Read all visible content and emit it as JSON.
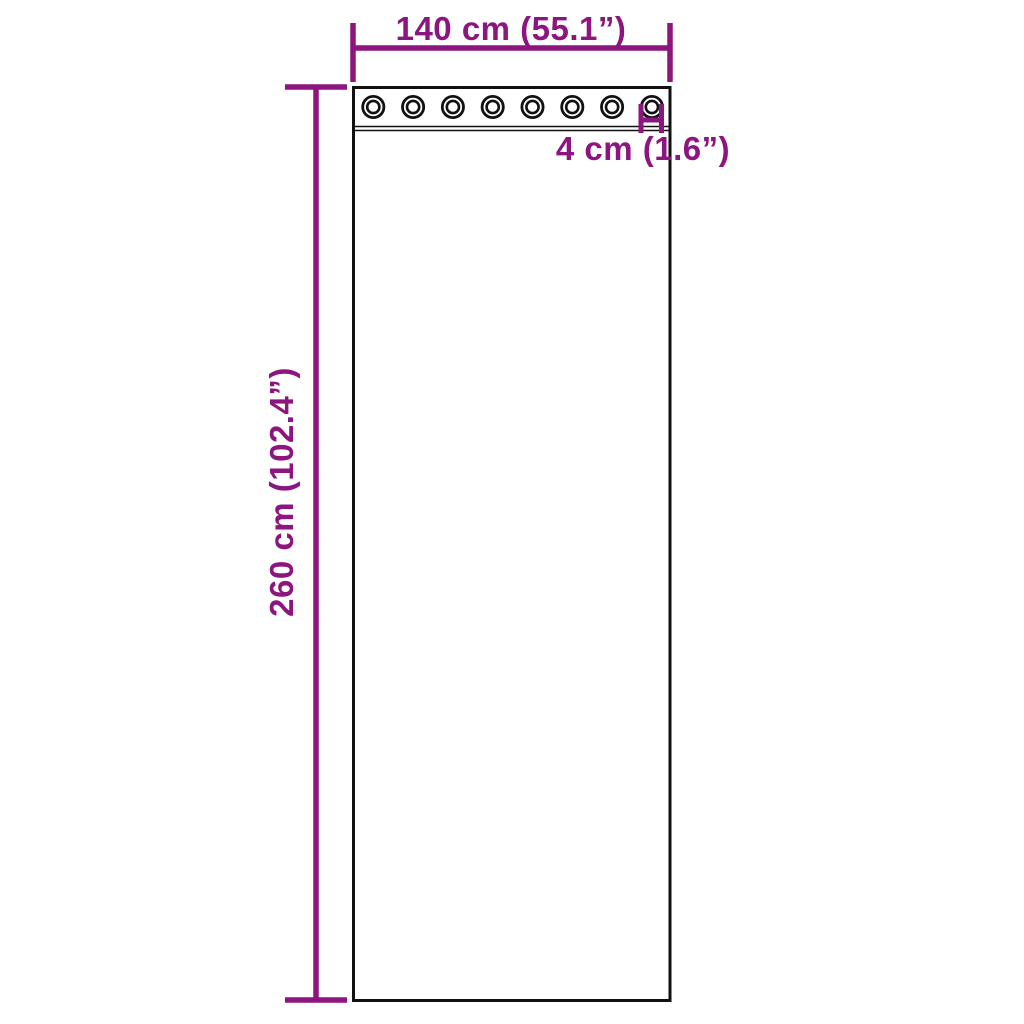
{
  "diagram": {
    "title": "curtain-with-grommets-dimension-diagram",
    "labels": {
      "width": "140 cm (55.1”)",
      "height": "260 cm (102.4”)",
      "grommet": "4 cm (1.6”)"
    },
    "curtain": {
      "grommet_count": 8,
      "grommet_shape": "double-ring-eyelet"
    },
    "colors": {
      "accent": "#8D1580",
      "outline": "#111111",
      "background": "#ffffff"
    }
  }
}
